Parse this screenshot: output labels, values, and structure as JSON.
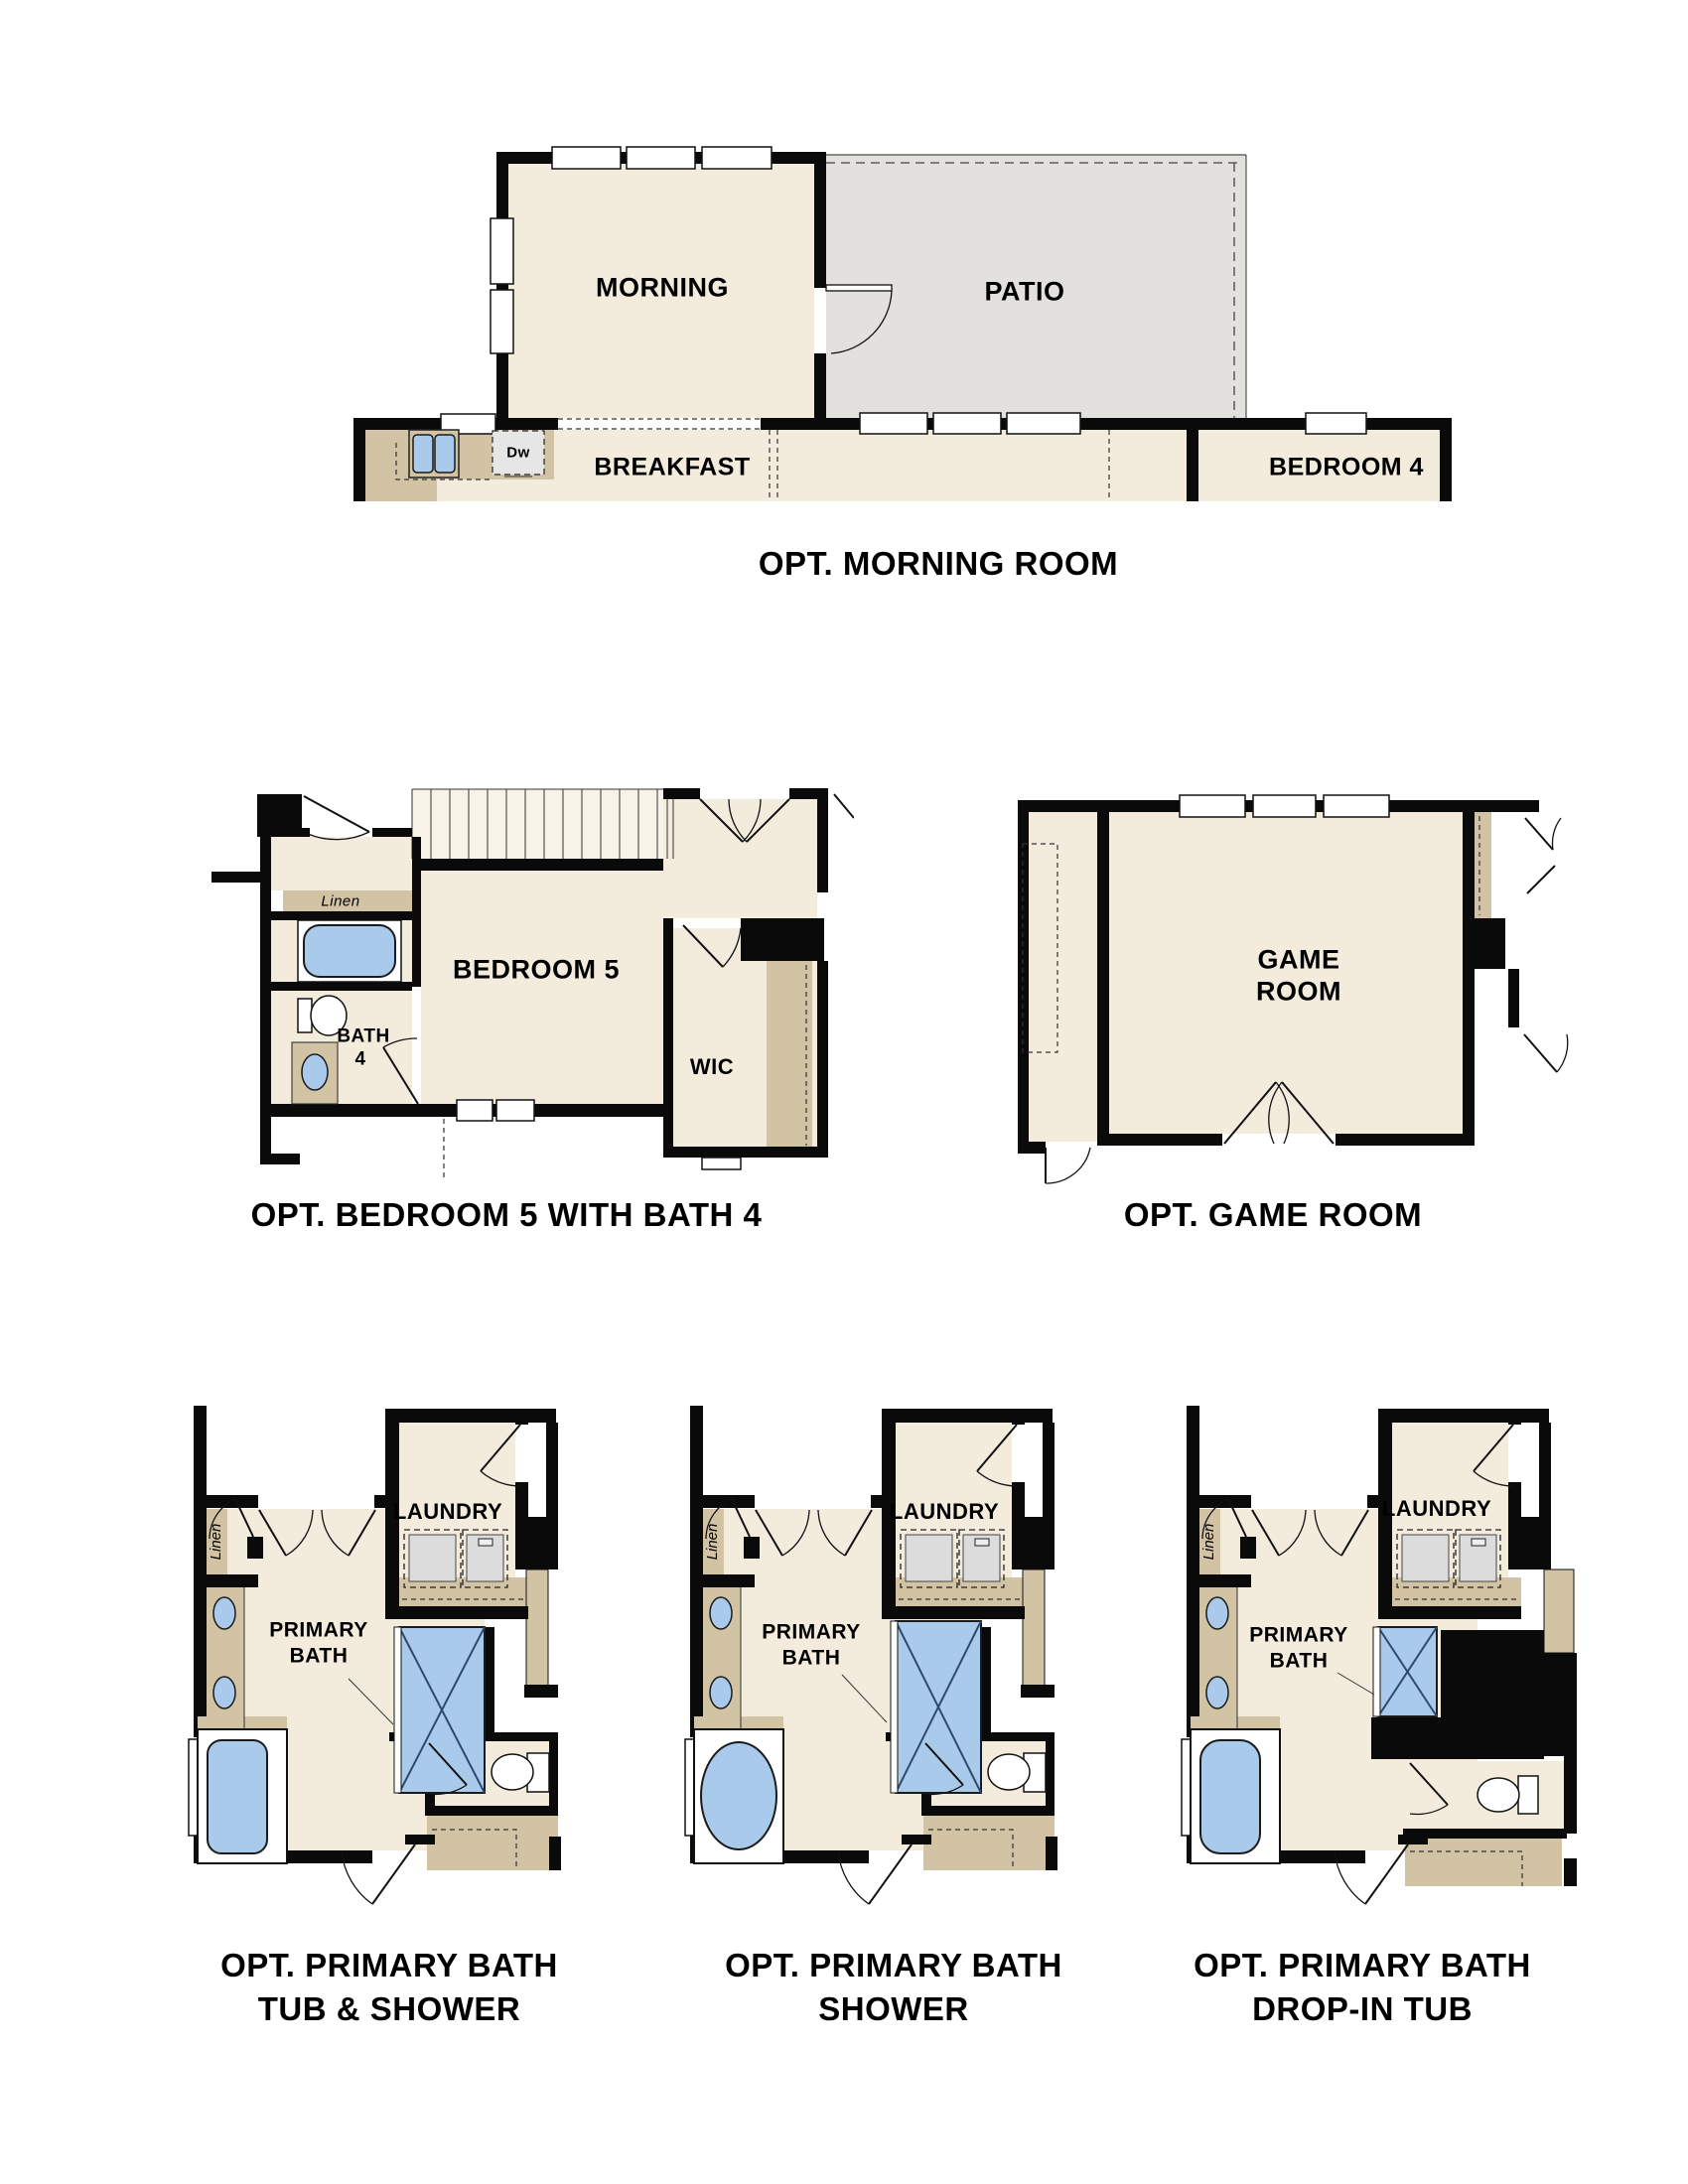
{
  "document": {
    "background": "#ffffff",
    "type": "floor-plan-options-sheet"
  },
  "colors": {
    "wall": "#0a0a0a",
    "room_fill": "#f3ecdd",
    "patio_fill": "#e3e1dd",
    "counter_tan": "#d2c3a4",
    "fixture_blue": "#aacaec",
    "appliance_gray": "#e4e4e4",
    "text": "#000000"
  },
  "plans": {
    "morning_room": {
      "caption": "OPT. MORNING ROOM",
      "labels": {
        "morning": "MORNING",
        "patio": "PATIO",
        "breakfast": "BREAKFAST",
        "bedroom4": "BEDROOM 4",
        "dishwasher": "Dw"
      }
    },
    "bedroom5": {
      "caption": "OPT. BEDROOM 5 WITH BATH 4",
      "labels": {
        "bedroom5": "BEDROOM 5",
        "bath_line1": "BATH",
        "bath_line2": "4",
        "wic": "WIC",
        "linen": "Linen"
      }
    },
    "game_room": {
      "caption": "OPT. GAME ROOM",
      "labels": {
        "line1": "GAME",
        "line2": "ROOM"
      }
    },
    "primary_bath_tub_shower": {
      "caption_line1": "OPT. PRIMARY BATH",
      "caption_line2": "TUB & SHOWER",
      "labels": {
        "laundry": "LAUNDRY",
        "primary_line1": "PRIMARY",
        "primary_line2": "BATH",
        "linen": "Linen"
      }
    },
    "primary_bath_shower": {
      "caption_line1": "OPT. PRIMARY BATH",
      "caption_line2": "SHOWER",
      "labels": {
        "laundry": "LAUNDRY",
        "primary_line1": "PRIMARY",
        "primary_line2": "BATH",
        "linen": "Linen"
      }
    },
    "primary_bath_dropin_tub": {
      "caption_line1": "OPT. PRIMARY BATH",
      "caption_line2": "DROP-IN TUB",
      "labels": {
        "laundry": "LAUNDRY",
        "primary_line1": "PRIMARY",
        "primary_line2": "BATH",
        "linen": "Linen"
      }
    }
  }
}
